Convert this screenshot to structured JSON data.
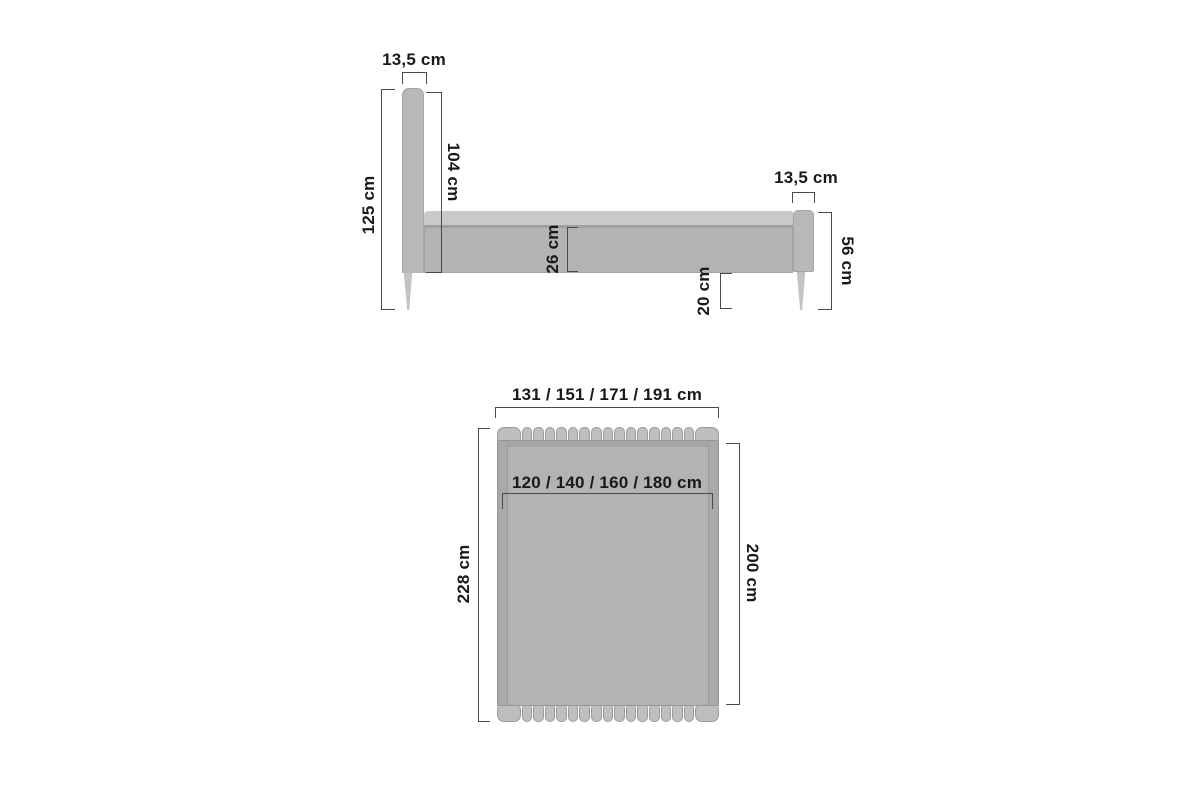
{
  "side_view": {
    "headboard_width": "13,5 cm",
    "overall_height": "125 cm",
    "headboard_panel_height": "104 cm",
    "frame_side_height": "26 cm",
    "floor_clearance": "20 cm",
    "footboard_width": "13,5 cm",
    "footboard_height": "56 cm"
  },
  "top_view": {
    "overall_widths": "131 / 151 / 171 / 191 cm",
    "mattress_widths": "120 / 140 / 160 / 180 cm",
    "overall_length": "228 cm",
    "mattress_length": "200 cm"
  },
  "colors": {
    "background": "#ffffff",
    "furniture_gray": "#b3b3b3",
    "furniture_light_gray": "#c9c9c9",
    "furniture_dark_gray": "#a5a5a5",
    "dimension_line": "#4a4a4a",
    "text": "#191919"
  }
}
